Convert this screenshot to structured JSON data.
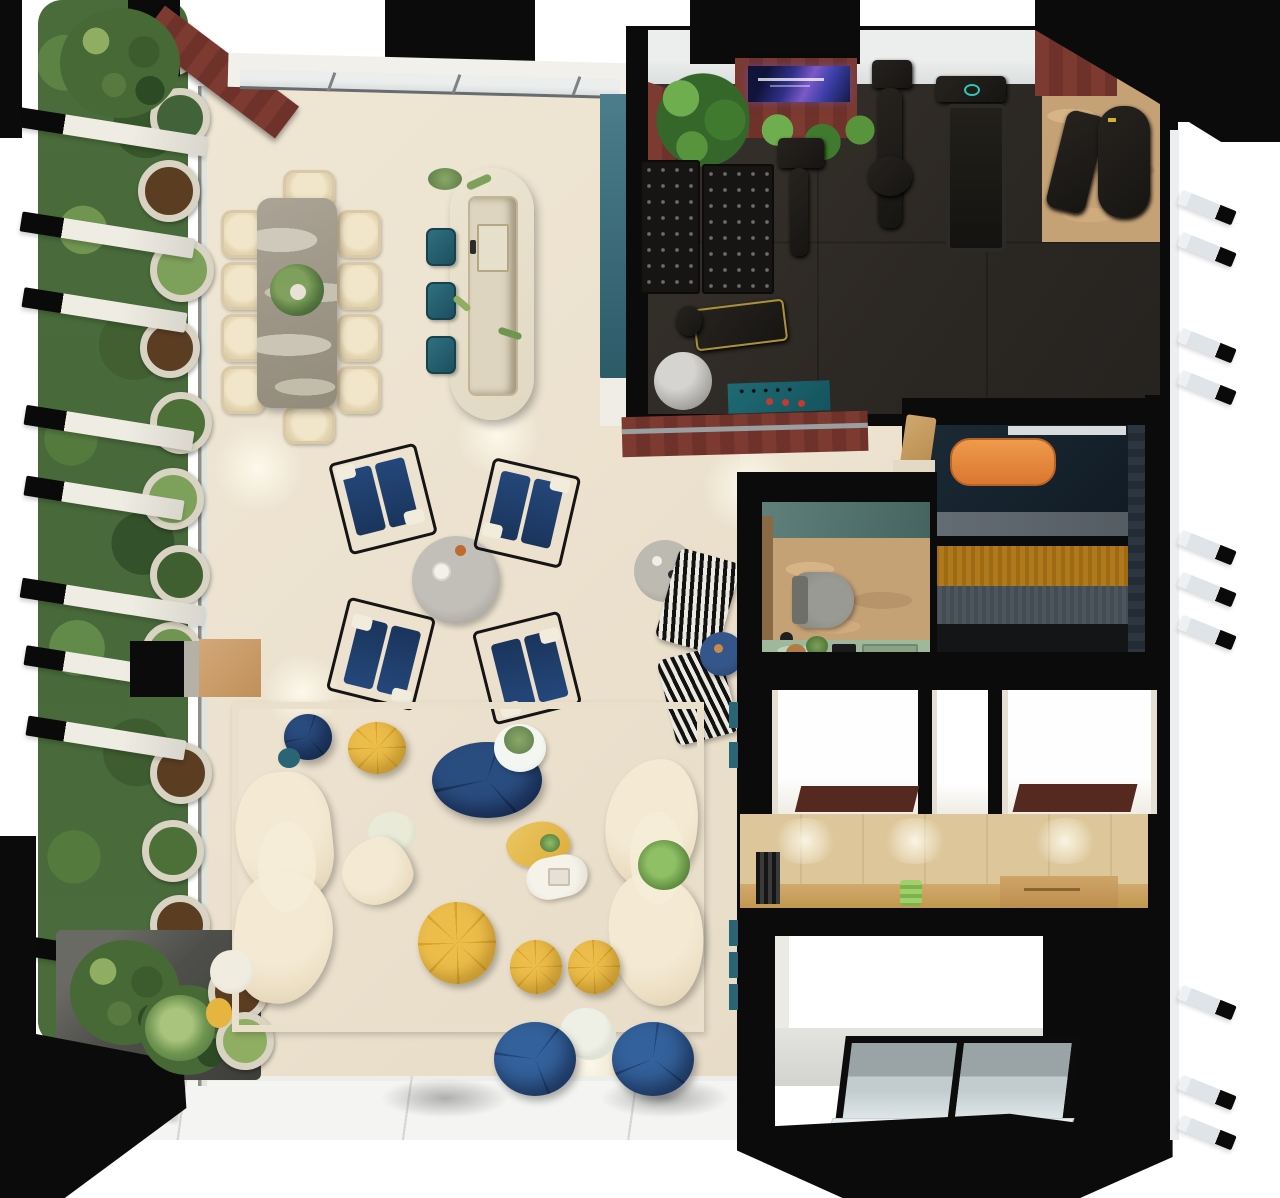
{
  "meta": {
    "title": "Top-down 3D render of an apartment floor plan",
    "canvas": {
      "width": 1280,
      "height": 1198
    },
    "view": "overhead cutaway render, no visible text"
  },
  "palette": {
    "cream_floor": "#ECE2CF",
    "white_tile": "#F3F4F2",
    "rug_green": "#B7C6AA",
    "rug_grout": "#EADFCA",
    "marble_table_gray": "#A39C8E",
    "chair_cream": "#E9DCBE",
    "stool_teal": "#2A6575",
    "panel_teal": "#3F7280",
    "gym_floor_dark": "#2F2B26",
    "maroon_wood": "#7C3A31",
    "wall_black": "#0B0B0B",
    "window_glass": "#E2E6E6",
    "travertine": "#C5A276",
    "vanity_green_marble": "#9FB79B",
    "sauna_amber_bench": "#B0791C",
    "sauna_concrete": "#5C656B",
    "sauna_floor_navy": "#152029",
    "lounger_orange": "#E08A3C",
    "navy_upholstery": "#1D3B66",
    "pouf_yellow": "#E5B53F",
    "cabinet_plywood": "#D8C194",
    "counter_wood": "#CAA269",
    "hedge_green": "#48693A",
    "planter_gray": "#4E4E4A"
  },
  "rooms": {
    "garden": {
      "label": "vertical-garden-terrace",
      "features": [
        "hedge-wall",
        "potted-plants-row",
        "facade-fins",
        "corner-planter-box"
      ]
    },
    "dining": {
      "label": "dining-area",
      "table": "gray-marble-rectangular",
      "seats": 10,
      "centerpiece": "green-plant"
    },
    "kitchen": {
      "label": "kitchen-island",
      "shape": "stadium-oval",
      "stools_teal": 3,
      "sink": true
    },
    "lounge": {
      "label": "lounge-circle",
      "navy_armchairs": 4,
      "round_gray_table": 1,
      "striped_chairs": 2,
      "navy_side_table": 1
    },
    "living": {
      "label": "green-marble-rug-lounge",
      "curved_cream_sofas": 2,
      "yellow_poufs": 3,
      "navy_poufs": 4,
      "organic_tables": [
        "yellow-blob-table",
        "white-bone-table",
        "cream-bear-table",
        "white-plant-table"
      ]
    },
    "gym": {
      "label": "home-gym",
      "equipment": [
        "wall-tv-screen",
        "dumbbell-rack",
        "dumbbell-rack",
        "exercise-bike",
        "multi-gym-machine",
        "treadmill",
        "leg-press",
        "weight-bench",
        "exercise-ball",
        "teal-floor-mat"
      ],
      "accents": [
        "maroon-wall-panels",
        "corner-plants",
        "glass-window-band"
      ]
    },
    "bathroom": {
      "label": "bathroom",
      "fixtures": [
        "toilet",
        "green-marble-vanity",
        "plants",
        "trays"
      ],
      "floor": "travertine"
    },
    "sauna": {
      "label": "sauna-steam-room",
      "features": [
        "orange-lounger",
        "concrete-step",
        "amber-wood-bench",
        "gray-bench",
        "towel-hooks",
        "entry-bench"
      ]
    },
    "closets": {
      "label": "wardrobe-corridor",
      "features": [
        "plywood-cabinets",
        "wood-counter",
        "green-glass-vase",
        "desk"
      ]
    },
    "bedrooms": {
      "label": "bright-rooms-trio",
      "count": 3,
      "features": [
        "maroon-wardrobe-tops"
      ]
    },
    "stairwell": {
      "label": "glass-skylight-stairwell",
      "panels": 2
    }
  }
}
